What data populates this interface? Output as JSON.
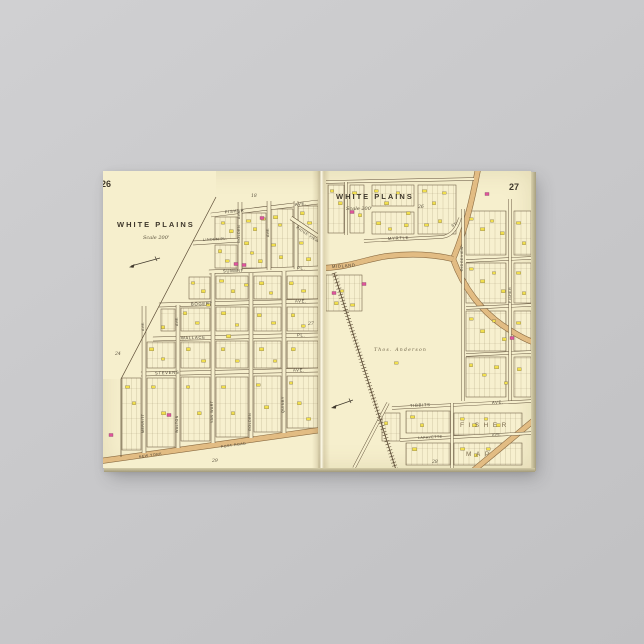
{
  "scene": {
    "background_color": "#c9c9cb",
    "item": "canvas print of vintage atlas spread"
  },
  "colors": {
    "paper": "#f6efcd",
    "ink": "#4a4234",
    "road_tan": "#e2bc83",
    "road_edge": "#8a6b42",
    "building_yellow": "#f1df4d",
    "building_pink": "#e0559b"
  },
  "left_page": {
    "sheet_number": "26",
    "title": "WHITE PLAINS",
    "scale_label": "Scale 200'",
    "adjacent_sheets": {
      "top": "18",
      "left": "24",
      "right": "27",
      "bottom": "29"
    },
    "streets": {
      "fisher": "FISHER",
      "fisher_suffix": "AVE.",
      "linden": "LINDEN PL.",
      "golden_upper": "GOLDEN",
      "golden_upper_suffix": "AVE.",
      "ave_upper": "AVE.",
      "ridge_view": "RIDGE VIEW",
      "summit": "SUMMIT",
      "summit_suffix": "PL.",
      "bogert": "BOGERT",
      "bogert_suffix": "AVE.",
      "wallace": "WALLACE",
      "wallace_suffix": "PL.",
      "stevens": "STEVENS",
      "stevens_suffix": "AVE.",
      "merritt": "MERRITT",
      "merritt_suffix": "AVE.",
      "walton": "WALTON",
      "walton_suffix": "AVE.",
      "van_wart": "VAN WART",
      "golden_lower": "GOLDEN",
      "quinby": "QUINBY",
      "new_york": "NEW YORK",
      "post_road": "POST ROAD"
    }
  },
  "right_page": {
    "sheet_number": "27",
    "title": "WHITE PLAINS",
    "scale_label": "Scale 200'",
    "adjacent_sheets": {
      "top": "26",
      "bottom": "28"
    },
    "streets": {
      "myrtle": "MYRTLE",
      "myrtle_suffix": "ST.",
      "midland": "MIDLAND",
      "ridgeview": "RIDGEVIEW",
      "fisher_vertical": "FISHER",
      "tibbits": "TIBBITS",
      "tibbits_suffix": "AVE.",
      "lafayette": "LAFAYETTE",
      "lafayette_suffix": "AVE."
    },
    "labels": {
      "estate": "Thos. Anderson",
      "subdivision_line1": "FISHER",
      "subdivision_line2": "MAP"
    }
  }
}
